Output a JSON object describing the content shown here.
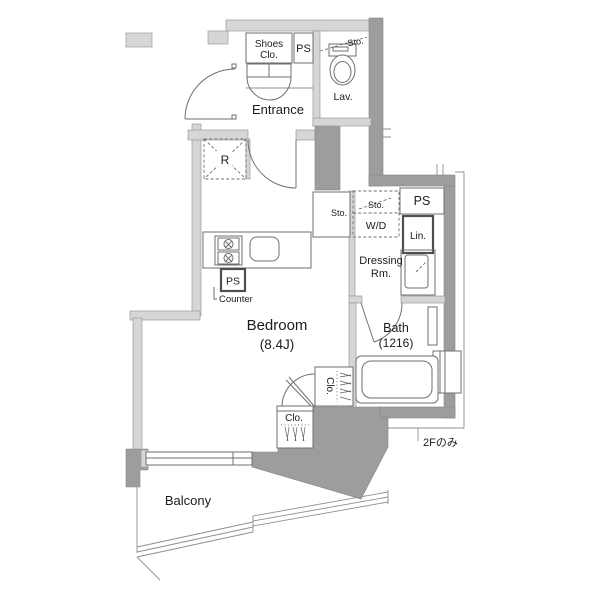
{
  "colors": {
    "wall_heavy": "#9d9d9d",
    "wall_light": "#d6d6d6",
    "line": "#6f6f6f",
    "text": "#1c1c1c"
  },
  "rooms": {
    "entrance": {
      "label": "Entrance"
    },
    "bedroom": {
      "label": "Bedroom",
      "size": "(8.4J)"
    },
    "bath": {
      "label": "Bath",
      "size": "(1216)"
    },
    "lavatory": {
      "label": "Lav."
    },
    "dressing": {
      "line1": "Dressing",
      "line2": "Rm."
    },
    "balcony": {
      "label": "Balcony"
    },
    "shoes_closet": {
      "line1": "Shoes",
      "line2": "Clo."
    }
  },
  "fixtures": {
    "refrigerator": "R",
    "washer_dryer": "W/D",
    "storage_above_wd": "Sto.",
    "storage_hall": "Sto.",
    "storage_lav": "Sto.",
    "linen": "Lin.",
    "counter": "Counter",
    "closet_right": "Clo.",
    "closet_bottom": "Clo.",
    "ps_top": "PS",
    "ps_right": "PS",
    "ps_kitchen": "PS"
  },
  "notes": {
    "floor_note": "2Fのみ"
  }
}
